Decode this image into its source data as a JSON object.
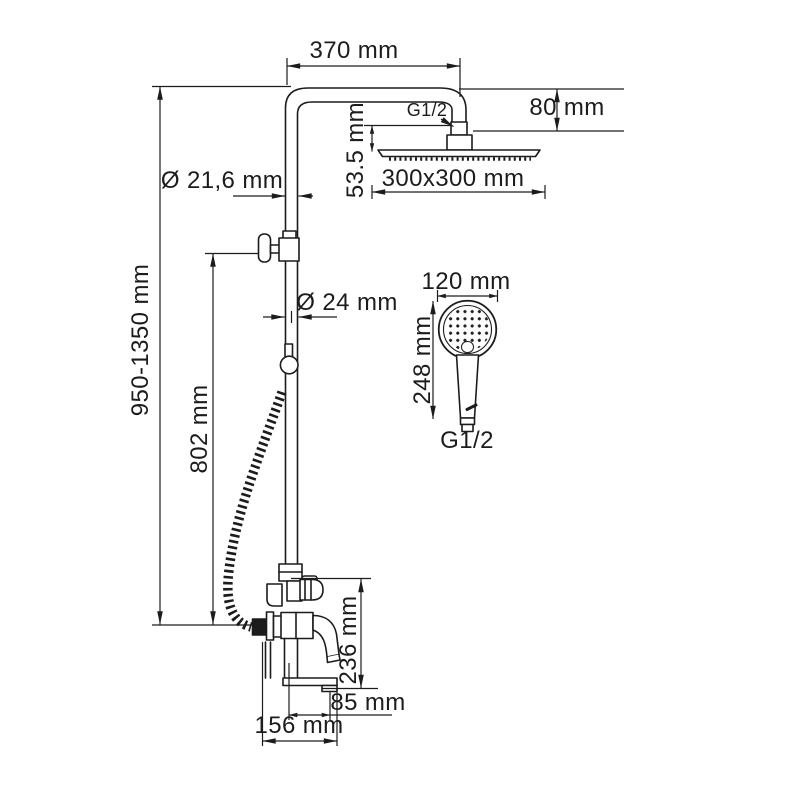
{
  "drawing": {
    "kind": "technical-dimension-drawing",
    "subject": "shower column system with rain head, hand shower and bath mixer",
    "line_color": "#1c1c1c",
    "background_color": "#ffffff"
  },
  "dimensions": {
    "arm_width": "370 mm",
    "overall_height": "950-1350 mm",
    "slider_height": "802 mm",
    "pipe_upper_diameter": "Ø 21,6 mm",
    "pipe_lower_diameter": "Ø 24 mm",
    "head_connection": "G1/2",
    "head_drop": "80 mm",
    "head_offset": "53.5 mm",
    "head_size": "300x300 mm",
    "handshower_diameter": "120 mm",
    "handshower_length": "248 mm",
    "handshower_connection": "G1/2",
    "spout_height": "236 mm",
    "spout_reach": "85 mm",
    "mixer_width": "156 mm"
  }
}
